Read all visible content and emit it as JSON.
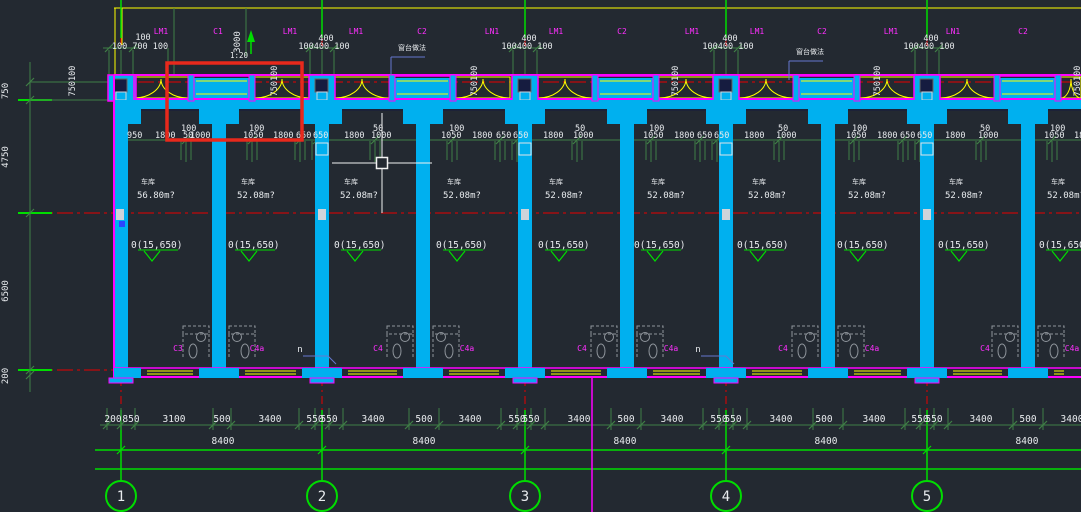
{
  "app": {
    "name": "cad-floor-plan-viewport"
  },
  "colors": {
    "bg": "#232931",
    "cyan": "#00b0ef",
    "magenta": "#ff00ff",
    "yellow": "#ffff00",
    "green": "#00dd00",
    "dim_green": "#3f7f46",
    "red": "#e80000",
    "selection_red": "#e8291c",
    "white": "#e8ebee",
    "gray": "#8f959c",
    "navy": "#161c40",
    "leader_blue": "#6678cf",
    "label_magenta": "#ff2fff"
  },
  "grid": {
    "xs": [
      121,
      322,
      525,
      726,
      927
    ],
    "bubble_labels": [
      "1",
      "2",
      "3",
      "4",
      "5"
    ],
    "bubble_y": 496,
    "bubble_r": 15
  },
  "walls": {
    "mid_xs": [
      219,
      423,
      627,
      828,
      1028
    ]
  },
  "band_labels": [
    [
      161,
      "LM1"
    ],
    [
      218,
      "C1"
    ],
    [
      290,
      "LM1"
    ],
    [
      356,
      "LM1"
    ],
    [
      422,
      "C2"
    ],
    [
      492,
      "LN1"
    ],
    [
      556,
      "LM1"
    ],
    [
      622,
      "C2"
    ],
    [
      692,
      "LM1"
    ],
    [
      757,
      "LM1"
    ],
    [
      822,
      "C2"
    ],
    [
      891,
      "LM1"
    ],
    [
      953,
      "LN1"
    ],
    [
      1023,
      "C2"
    ]
  ],
  "top_dims": {
    "grid1_top": "100",
    "grid1_bottom": "100 700 100",
    "top": "400",
    "bottom": "100400 100"
  },
  "vert_dim_3000": "3000",
  "rot_dim": {
    "text": "750100",
    "xs": [
      75,
      277,
      477,
      678,
      880,
      1080
    ]
  },
  "left_dims": [
    [
      91,
      "750"
    ],
    [
      157,
      "4750"
    ],
    [
      291,
      "6500"
    ],
    [
      376,
      "200"
    ]
  ],
  "mid_dims_small": [
    [
      181,
      "100"
    ],
    [
      249,
      "100"
    ],
    [
      373,
      "50"
    ],
    [
      449,
      "100"
    ],
    [
      575,
      "50"
    ],
    [
      649,
      "100"
    ],
    [
      778,
      "50"
    ],
    [
      852,
      "100"
    ],
    [
      980,
      "50"
    ],
    [
      1050,
      "100"
    ]
  ],
  "mid_dims_main": [
    [
      127,
      "950"
    ],
    [
      155,
      "1800"
    ],
    [
      183,
      "50"
    ],
    [
      190,
      "1000"
    ],
    [
      243,
      "1050"
    ],
    [
      273,
      "1800"
    ],
    [
      296,
      "650"
    ],
    [
      313,
      "650"
    ],
    [
      344,
      "1800"
    ],
    [
      371,
      "1000"
    ],
    [
      441,
      "1050"
    ],
    [
      472,
      "1800"
    ],
    [
      496,
      "650"
    ],
    [
      513,
      "650"
    ],
    [
      543,
      "1800"
    ],
    [
      573,
      "1000"
    ],
    [
      643,
      "1050"
    ],
    [
      674,
      "1800"
    ],
    [
      697,
      "650"
    ],
    [
      714,
      "650"
    ],
    [
      744,
      "1800"
    ],
    [
      776,
      "1000"
    ],
    [
      846,
      "1050"
    ],
    [
      877,
      "1800"
    ],
    [
      900,
      "650"
    ],
    [
      917,
      "650"
    ],
    [
      945,
      "1800"
    ],
    [
      978,
      "1000"
    ],
    [
      1044,
      "1050"
    ],
    [
      1074,
      "1800"
    ]
  ],
  "rooms": {
    "name": "车库",
    "areas": [
      [
        137,
        "56.80m?"
      ],
      [
        237,
        "52.08m?"
      ],
      [
        340,
        "52.08m?"
      ],
      [
        443,
        "52.08m?"
      ],
      [
        545,
        "52.08m?"
      ],
      [
        647,
        "52.08m?"
      ],
      [
        748,
        "52.08m?"
      ],
      [
        848,
        "52.08m?"
      ],
      [
        945,
        "52.08m?"
      ],
      [
        1047,
        "52.08m?"
      ]
    ]
  },
  "elev": {
    "text": "0(15,650)",
    "xs": [
      131,
      228,
      334,
      436,
      538,
      634,
      737,
      837,
      938,
      1039
    ]
  },
  "bottom_dims": [
    [
      113,
      "200"
    ],
    [
      131,
      "850"
    ],
    [
      174,
      "3100"
    ],
    [
      222,
      "500"
    ],
    [
      270,
      "3400"
    ],
    [
      315,
      "550"
    ],
    [
      329,
      "550"
    ],
    [
      373,
      "3400"
    ],
    [
      424,
      "500"
    ],
    [
      470,
      "3400"
    ],
    [
      517,
      "550"
    ],
    [
      531,
      "550"
    ],
    [
      579,
      "3400"
    ],
    [
      626,
      "500"
    ],
    [
      672,
      "3400"
    ],
    [
      719,
      "550"
    ],
    [
      733,
      "550"
    ],
    [
      781,
      "3400"
    ],
    [
      824,
      "500"
    ],
    [
      874,
      "3400"
    ],
    [
      920,
      "550"
    ],
    [
      934,
      "550"
    ],
    [
      981,
      "3400"
    ],
    [
      1028,
      "500"
    ],
    [
      1072,
      "3400"
    ]
  ],
  "bay_totals": {
    "text": "8400",
    "xs": [
      223,
      424,
      625,
      826,
      1027
    ]
  },
  "door_labels": [
    [
      178,
      "C3"
    ],
    [
      257,
      "C4a"
    ],
    [
      378,
      "C4"
    ],
    [
      467,
      "C4a"
    ],
    [
      582,
      "C4"
    ],
    [
      671,
      "C4a"
    ],
    [
      783,
      "C4"
    ],
    [
      872,
      "C4a"
    ],
    [
      985,
      "C4"
    ],
    [
      1072,
      "C4a"
    ]
  ],
  "n_marks": {
    "text": "n",
    "xs": [
      300,
      698
    ]
  },
  "callouts": [
    {
      "x": 398,
      "y": 50,
      "text": "窗台做法"
    },
    {
      "x": 796,
      "y": 54,
      "text": "窗台做法"
    }
  ],
  "slope": {
    "text": "1:20",
    "x": 239,
    "y": 58,
    "arrow_x": 251
  },
  "selection_rect": {
    "x": 167,
    "y": 63,
    "w": 135,
    "h": 77
  },
  "cursor": {
    "x": 382,
    "y": 163,
    "h_x1": 332,
    "h_x2": 432,
    "v_y1": 113,
    "v_y2": 213,
    "box": 11
  },
  "mid_tick_xs": [
    186,
    252,
    300,
    317,
    375,
    452,
    500,
    517,
    577,
    651,
    700,
    717,
    779,
    854,
    903,
    920,
    981,
    1052
  ],
  "bottom_tick_xs": [
    107,
    121,
    135,
    213,
    231,
    299,
    315,
    329,
    343,
    409,
    439,
    501,
    517,
    531,
    545,
    611,
    641,
    703,
    719,
    733,
    747,
    813,
    843,
    905,
    920,
    934,
    948,
    1013,
    1043
  ],
  "left_tick_ys": [
    82,
    100,
    213,
    370,
    375
  ]
}
